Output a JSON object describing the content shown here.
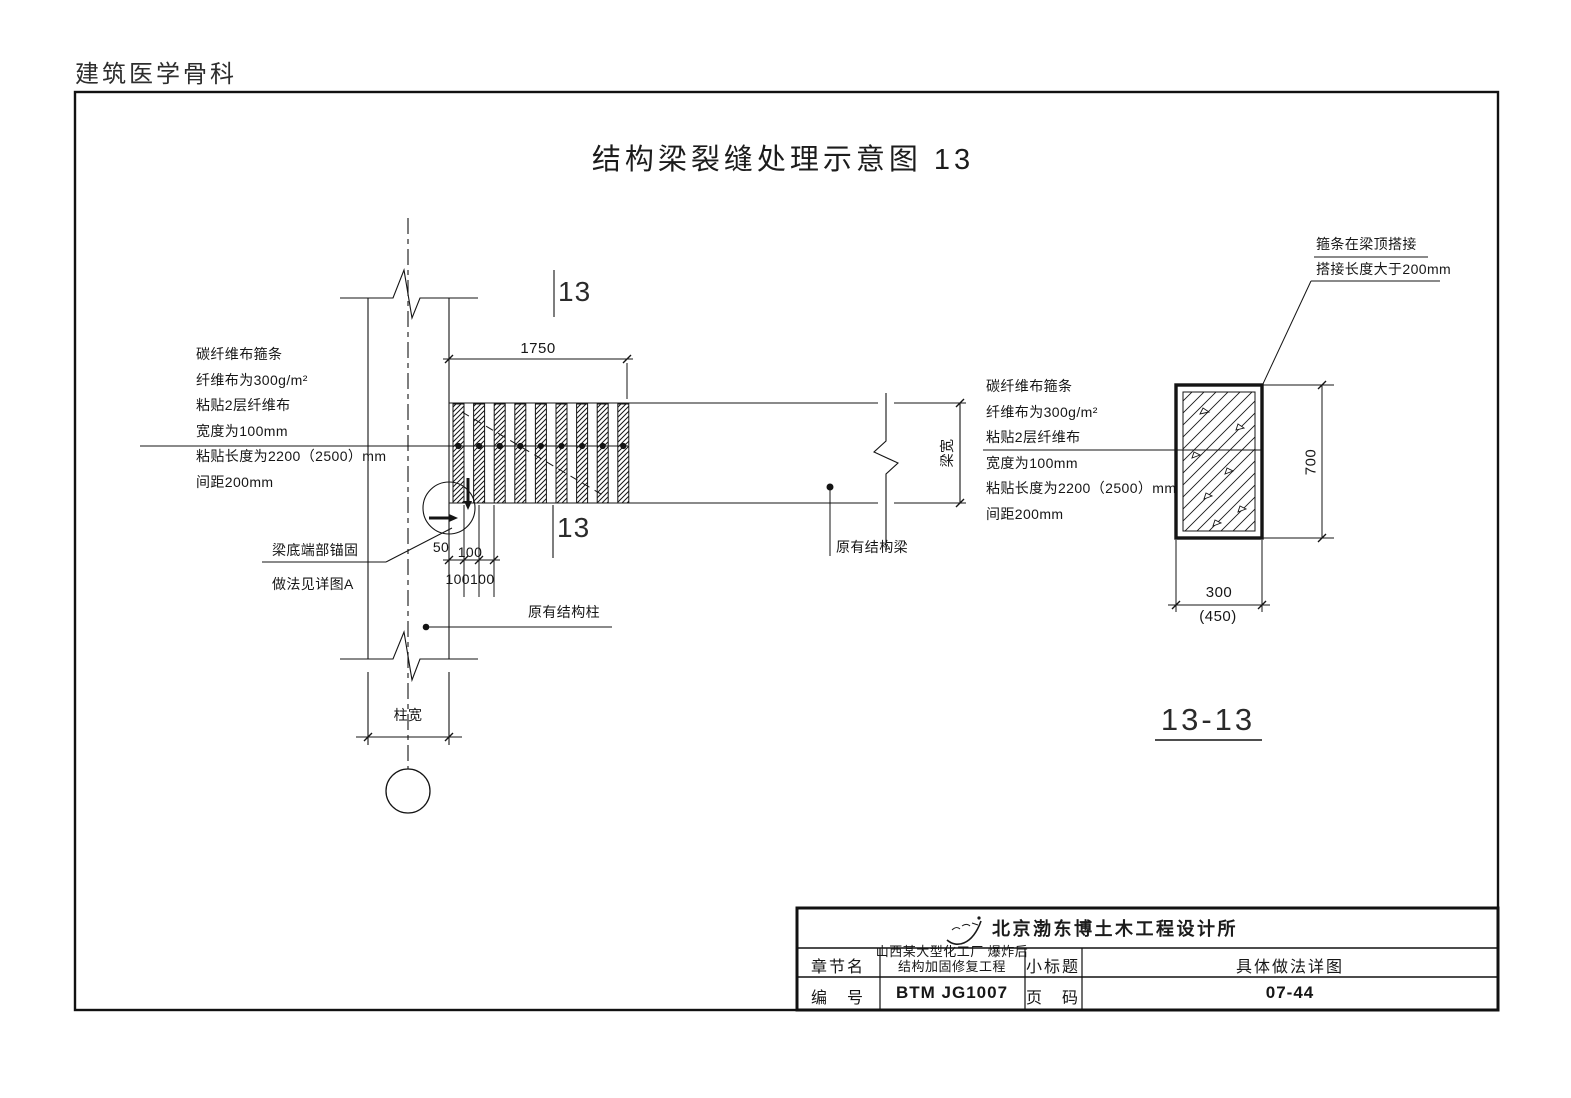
{
  "page": {
    "watermark": "建筑医学骨科",
    "title": "结构梁裂缝处理示意图 13"
  },
  "cfrp_note": {
    "l1": "碳纤维布箍条",
    "l2": "纤维布为300g/m²",
    "l3": "粘贴2层纤维布",
    "l4": "宽度为100mm",
    "l5": "粘贴长度为2200（2500）mm",
    "l6": "间距200mm"
  },
  "elevation": {
    "marker_top": "13",
    "marker_bottom": "13",
    "dim_span": "1750",
    "dim_50": "50",
    "dim_100": "100",
    "dim_100_100": "100100",
    "dim_beam_width": "梁宽",
    "dim_col_width": "柱宽",
    "anchor_note_l1": "梁底端部锚固",
    "anchor_note_l2": "做法见详图A",
    "col_label": "原有结构柱",
    "beam_label": "原有结构梁"
  },
  "section": {
    "lap_note_l1": "箍条在梁顶搭接",
    "lap_note_l2": "搭接长度大于200mm",
    "dim_height": "700",
    "dim_width": "300",
    "dim_width_alt": "(450)",
    "label": "13-13"
  },
  "titleblock": {
    "company": "北京渤东博土木工程设计所",
    "chapter_label": "章节名",
    "project_l1": "山西某大型化工厂 爆炸后",
    "project_l2": "结构加固修复工程",
    "subtitle_label": "小标题",
    "subtitle_value": "具体做法详图",
    "number_label": "编　号",
    "number_value": "BTM JG1007",
    "page_label": "页　码",
    "page_value": "07-44"
  }
}
